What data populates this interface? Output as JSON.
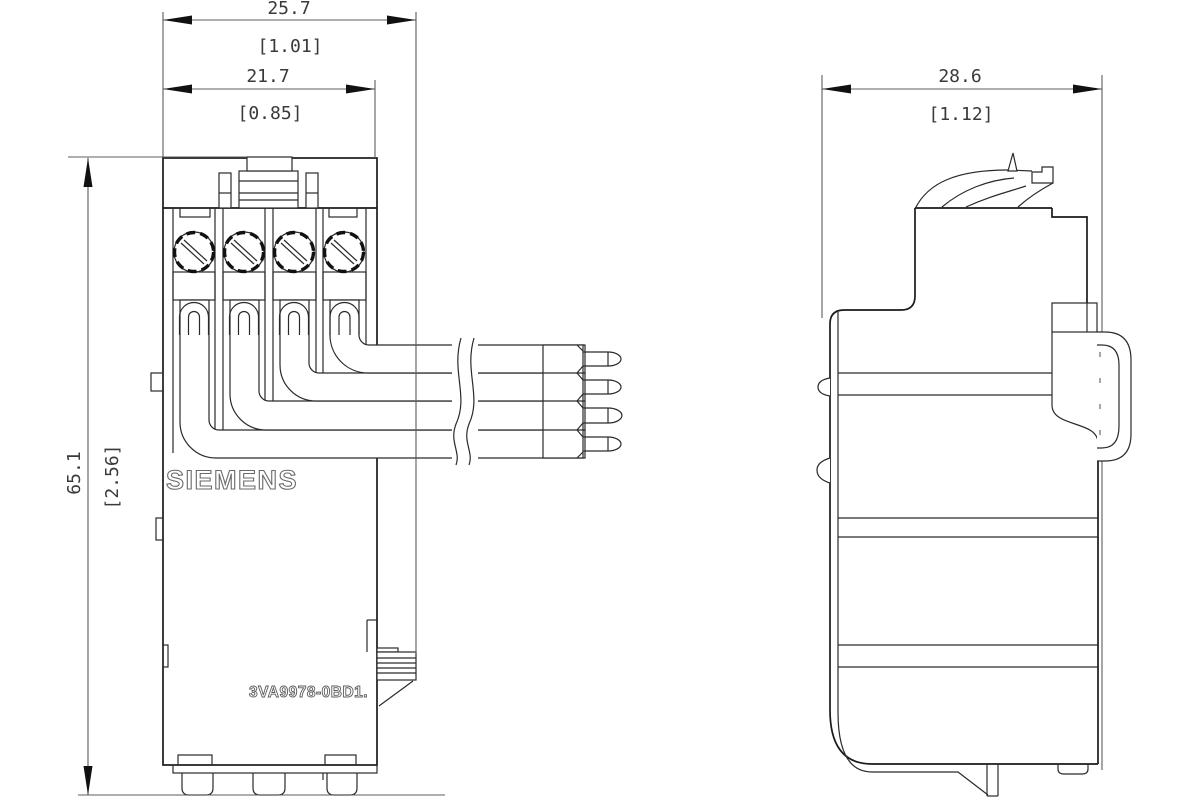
{
  "drawing": {
    "type": "technical-dimension-drawing",
    "brand": "SIEMENS",
    "part_number": "3VA9978-0BD1.",
    "dimensions": {
      "width_overall": {
        "mm": "25.7",
        "inch": "[1.01]"
      },
      "width_body": {
        "mm": "21.7",
        "inch": "[0.85]"
      },
      "height": {
        "mm": "65.1",
        "inch": "[2.56]"
      },
      "depth": {
        "mm": "28.6",
        "inch": "[1.12]"
      }
    },
    "features": {
      "terminal_count": 4,
      "pin_count": 4,
      "views": [
        "front",
        "side"
      ]
    },
    "colors": {
      "background": "#ffffff",
      "body_line": "#1a1a1a",
      "dimension_line": "#5c5c5c",
      "text": "#3a3a3a"
    }
  }
}
